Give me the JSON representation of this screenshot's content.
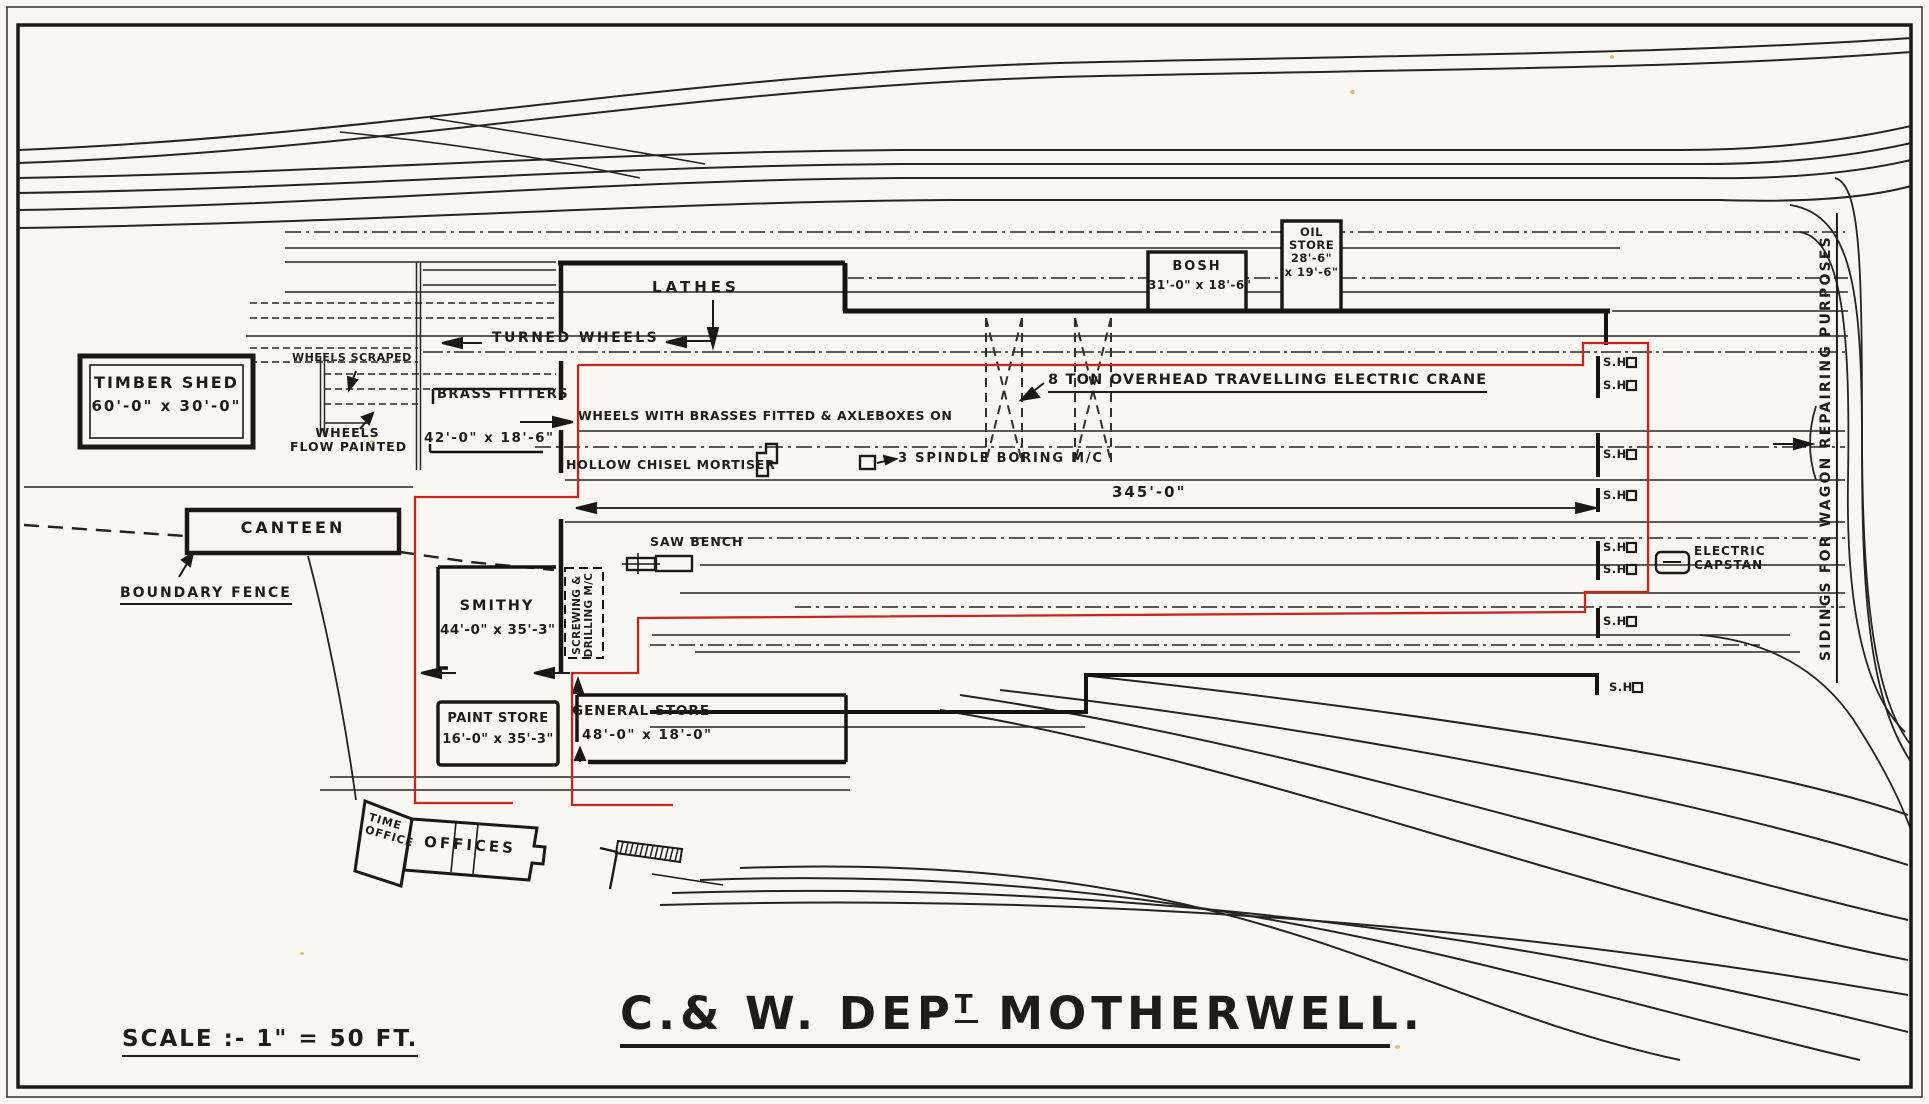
{
  "meta": {
    "drawing_type": "railway works site plan",
    "location": "Motherwell"
  },
  "colors": {
    "paper": "#f9f7f1",
    "ink": "#1e1c1a",
    "red": "#c8251d"
  },
  "title": {
    "prefix": "C.& W. DEP",
    "superscript": "T",
    "suffix": " MOTHERWELL."
  },
  "scale": {
    "label": "SCALE :- 1\" = 50 FT."
  },
  "buildings": {
    "timber_shed": {
      "name": "TIMBER SHED",
      "dims": "60'-0\" x 30'-0\""
    },
    "canteen": {
      "name": "CANTEEN"
    },
    "smithy": {
      "name": "SMITHY",
      "dims": "44'-0\" x 35'-3\""
    },
    "paint_store": {
      "name": "PAINT STORE",
      "dims": "16'-0\" x 35'-3\""
    },
    "general_store": {
      "name": "GENERAL STORE",
      "dims": "48'-0\" x 18'-0\""
    },
    "brass_fitters": {
      "name": "BRASS FITTERS",
      "dims": "42'-0\" x 18'-6\""
    },
    "bosh": {
      "name": "BOSH",
      "dims": "31'-0\" x 18'-6\""
    },
    "oil_store": {
      "line1": "OIL",
      "line2": "STORE",
      "line3": "28'-6\"",
      "line4": "x 19'-6\""
    },
    "time_office": {
      "line1": "TIME",
      "line2": "OFFICE"
    },
    "offices": {
      "name": "OFFICES"
    },
    "screwing_drilling": {
      "line1": "SCREWING &",
      "line2": "DRILLING M/C"
    }
  },
  "annotations": {
    "lathes": "LATHES",
    "turned_wheels": "TURNED WHEELS",
    "wheels_scraped": "WHEELS SCRAPED",
    "wheels_flow_painted_1": "WHEELS",
    "wheels_flow_painted_2": "FLOW PAINTED",
    "wheels_with_brasses": "WHEELS WITH BRASSES FITTED & AXLEBOXES ON",
    "hollow_chisel_mortiser": "HOLLOW CHISEL MORTISER",
    "spindle_boring": "3 SPINDLE BORING M/C",
    "crane": "8 TON OVERHEAD TRAVELLING ELECTRIC CRANE",
    "saw_bench": "SAW BENCH",
    "boundary_fence": "BOUNDARY FENCE",
    "electric_capstan_1": "ELECTRIC",
    "electric_capstan_2": "CAPSTAN",
    "sidings": "SIDINGS FOR WAGON REPAIRING PURPOSES",
    "length_dim": "345'-0\"",
    "sh": "S.H"
  }
}
